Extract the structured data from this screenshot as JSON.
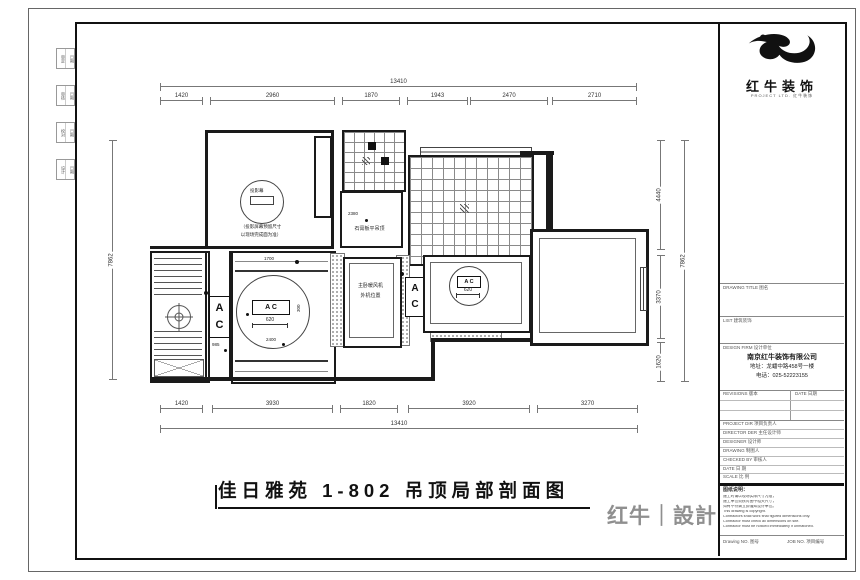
{
  "plan": {
    "title": "佳日雅苑 1-802 吊顶局部剖面图",
    "dims": {
      "top_overall": "13410",
      "top_segments": [
        "1420",
        "2960",
        "1870",
        "1943",
        "2470",
        "2710"
      ],
      "bottom_segments": [
        "1420",
        "3930",
        "1820",
        "3920",
        "3270"
      ],
      "bottom_overall": "13410",
      "left_overall": "7862",
      "right_segments": [
        "4440",
        "3370",
        "1620"
      ],
      "right_overall": "7862"
    },
    "labels": {
      "projector_screen": "投影幕",
      "projector_note1": "（投影屏幕预留尺寸",
      "projector_note2": "以现场完成面为准）",
      "gypsum_ceiling": "石膏板平吊顶",
      "gypsum_dim": "2380",
      "heater_line1": "主卧暖风机",
      "heater_line2": "外机位置",
      "ac_a": "A",
      "ac_c": "C",
      "circle_ac": "A C",
      "circle_dim": "620",
      "circle_dim_side": "300",
      "corridor_dim": "985",
      "band_dim_top": "1700",
      "band_dim_bottom": "2400"
    }
  },
  "margin_strip": {
    "boxes": [
      {
        "a": "审定",
        "b": "日期"
      },
      {
        "a": "审核",
        "b": "日期"
      },
      {
        "a": "校对",
        "b": "日期"
      },
      {
        "a": "设计",
        "b": "日期"
      }
    ]
  },
  "title_block": {
    "brand_name": "红牛装饰",
    "brand_tagline": "PROJECT LTD.  红牛装饰",
    "field_drawing_title": "DRAWING TITLE 图名",
    "field_list": "LIST 建筑装饰",
    "field_design_firm": "DESIGN FIRM 设计单位",
    "company": "南京红牛装饰有限公司",
    "address": "地址：龙蟠中路458号一楼",
    "phone": "电话：025-52223155",
    "field_revisions": "REVISIONS 版本",
    "field_date": "DATE 日期",
    "rows": [
      "PROJECT DIR 项目负责人",
      "DIRECTOR DER 主任设计师",
      "DESIGNER 设计师",
      "DRAWING 制图人",
      "CHECKED BY 审核人",
      "DATE 日 期",
      "SCALE 比 例"
    ],
    "notes_title": "图纸说明：",
    "notes": [
      "施工时请以现场实际尺寸为准，",
      "施工单位须核对图中相关尺寸，",
      "如有不符请立即通知设计单位。",
      "This drawing is copyright.",
      "Contractors shall work final figured dimensions only.",
      "Contractor must check all dimensions on site.",
      "Contractor must be noticed immediately if unmatched."
    ],
    "drawing_no_label": "Drawing NO. 图号",
    "job_no_label": "JOB NO. 项目编号"
  },
  "footer": {
    "brand": "红牛｜設計"
  }
}
